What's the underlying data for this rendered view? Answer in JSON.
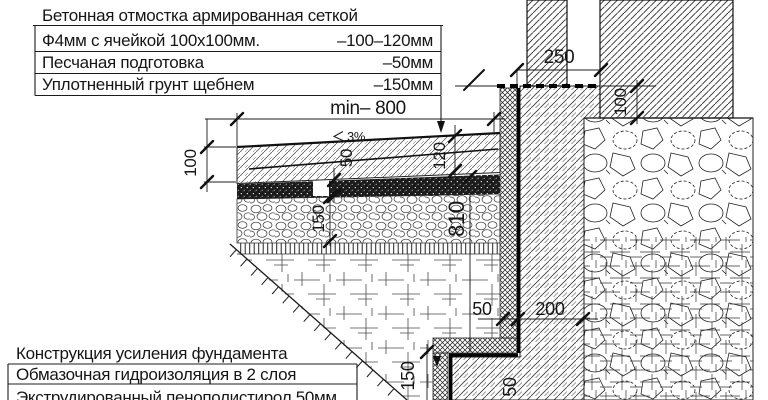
{
  "legend_top": {
    "title": "Бетонная отмостка армированная сеткой",
    "rows": [
      {
        "label": "Ф4мм с ячейкой 100х100мм.",
        "value": "–100–120мм"
      },
      {
        "label": "Песчаная подготовка",
        "value": "–50мм"
      },
      {
        "label": "Уплотненный грунт щебнем",
        "value": "–150мм"
      }
    ]
  },
  "legend_bottom": {
    "rows": [
      {
        "label": "Конструкция усиления фундамента"
      },
      {
        "label": "Обмазочная гидроизоляция в 2 слоя"
      },
      {
        "label": "Экструдированный пенополистирол 50мм"
      }
    ]
  },
  "dimensions": {
    "blind_area_min_width": "min– 800",
    "slope_percent": "3%",
    "edge_thickness": "100",
    "sand_layer": "50",
    "crushed_stone_layer": "150",
    "wall_side_thickness": "120",
    "foundation_depth": "810",
    "wall_thickness": "250",
    "foundation_ledge": "100",
    "insulation_thickness": "50",
    "footing_width": "200",
    "footing_step": "150",
    "footing_bottom": "50"
  },
  "colors": {
    "ink": "#1c1c1c",
    "background": "#ffffff"
  }
}
